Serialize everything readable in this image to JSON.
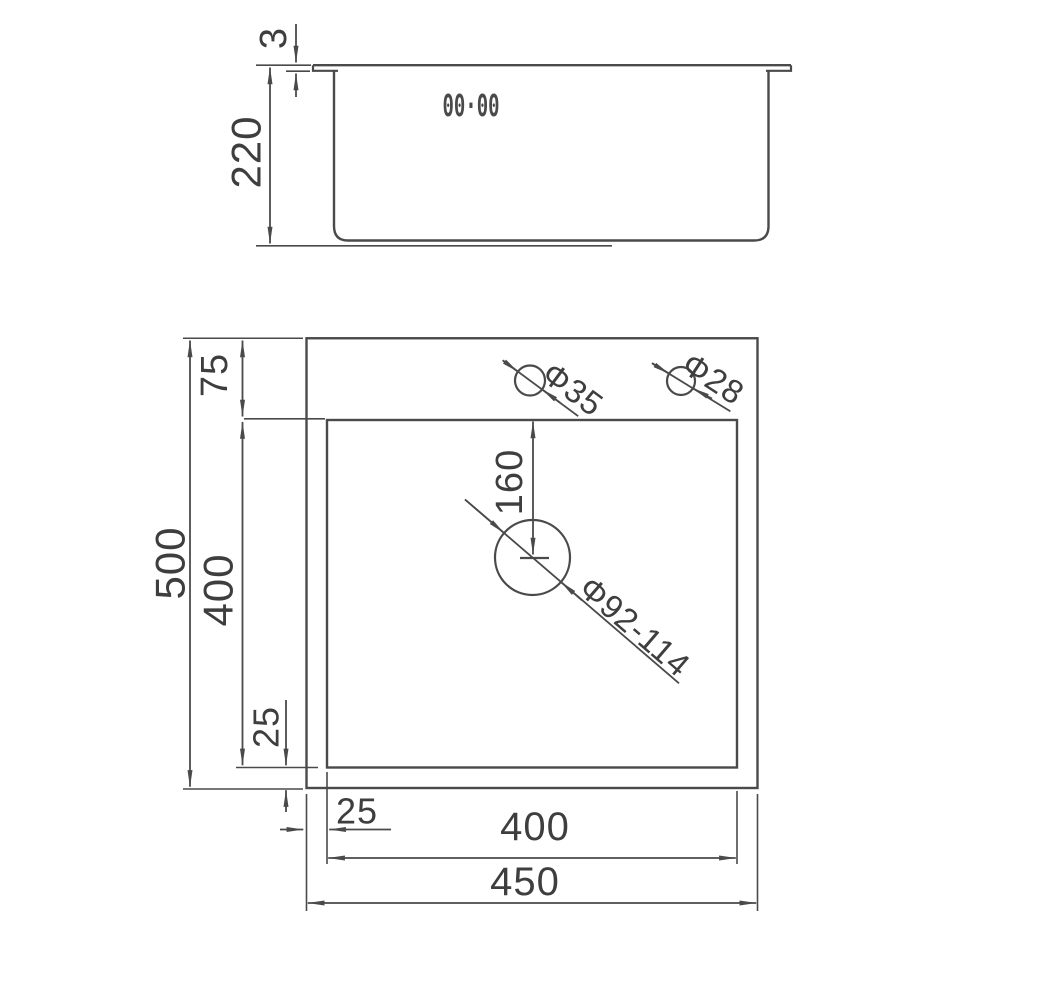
{
  "drawing": {
    "colors": {
      "line": "#4a4a4a",
      "text": "#3e3e3e",
      "background": "#ffffff"
    },
    "side_view": {
      "logo_text": "00·00",
      "rim_thickness_label": "3",
      "depth_label": "220"
    },
    "plan_view": {
      "overall_length_label": "500",
      "rear_ledge_label": "75",
      "bowl_length_label": "400",
      "front_ledge_label": "25",
      "side_ledge_label": "25",
      "bowl_width_label": "400",
      "overall_width_label": "450",
      "drain_offset_label": "160",
      "tap_hole_label": "Φ35",
      "accessory_hole_label": "Φ28",
      "drain_hole_label": "Φ92-114"
    }
  }
}
